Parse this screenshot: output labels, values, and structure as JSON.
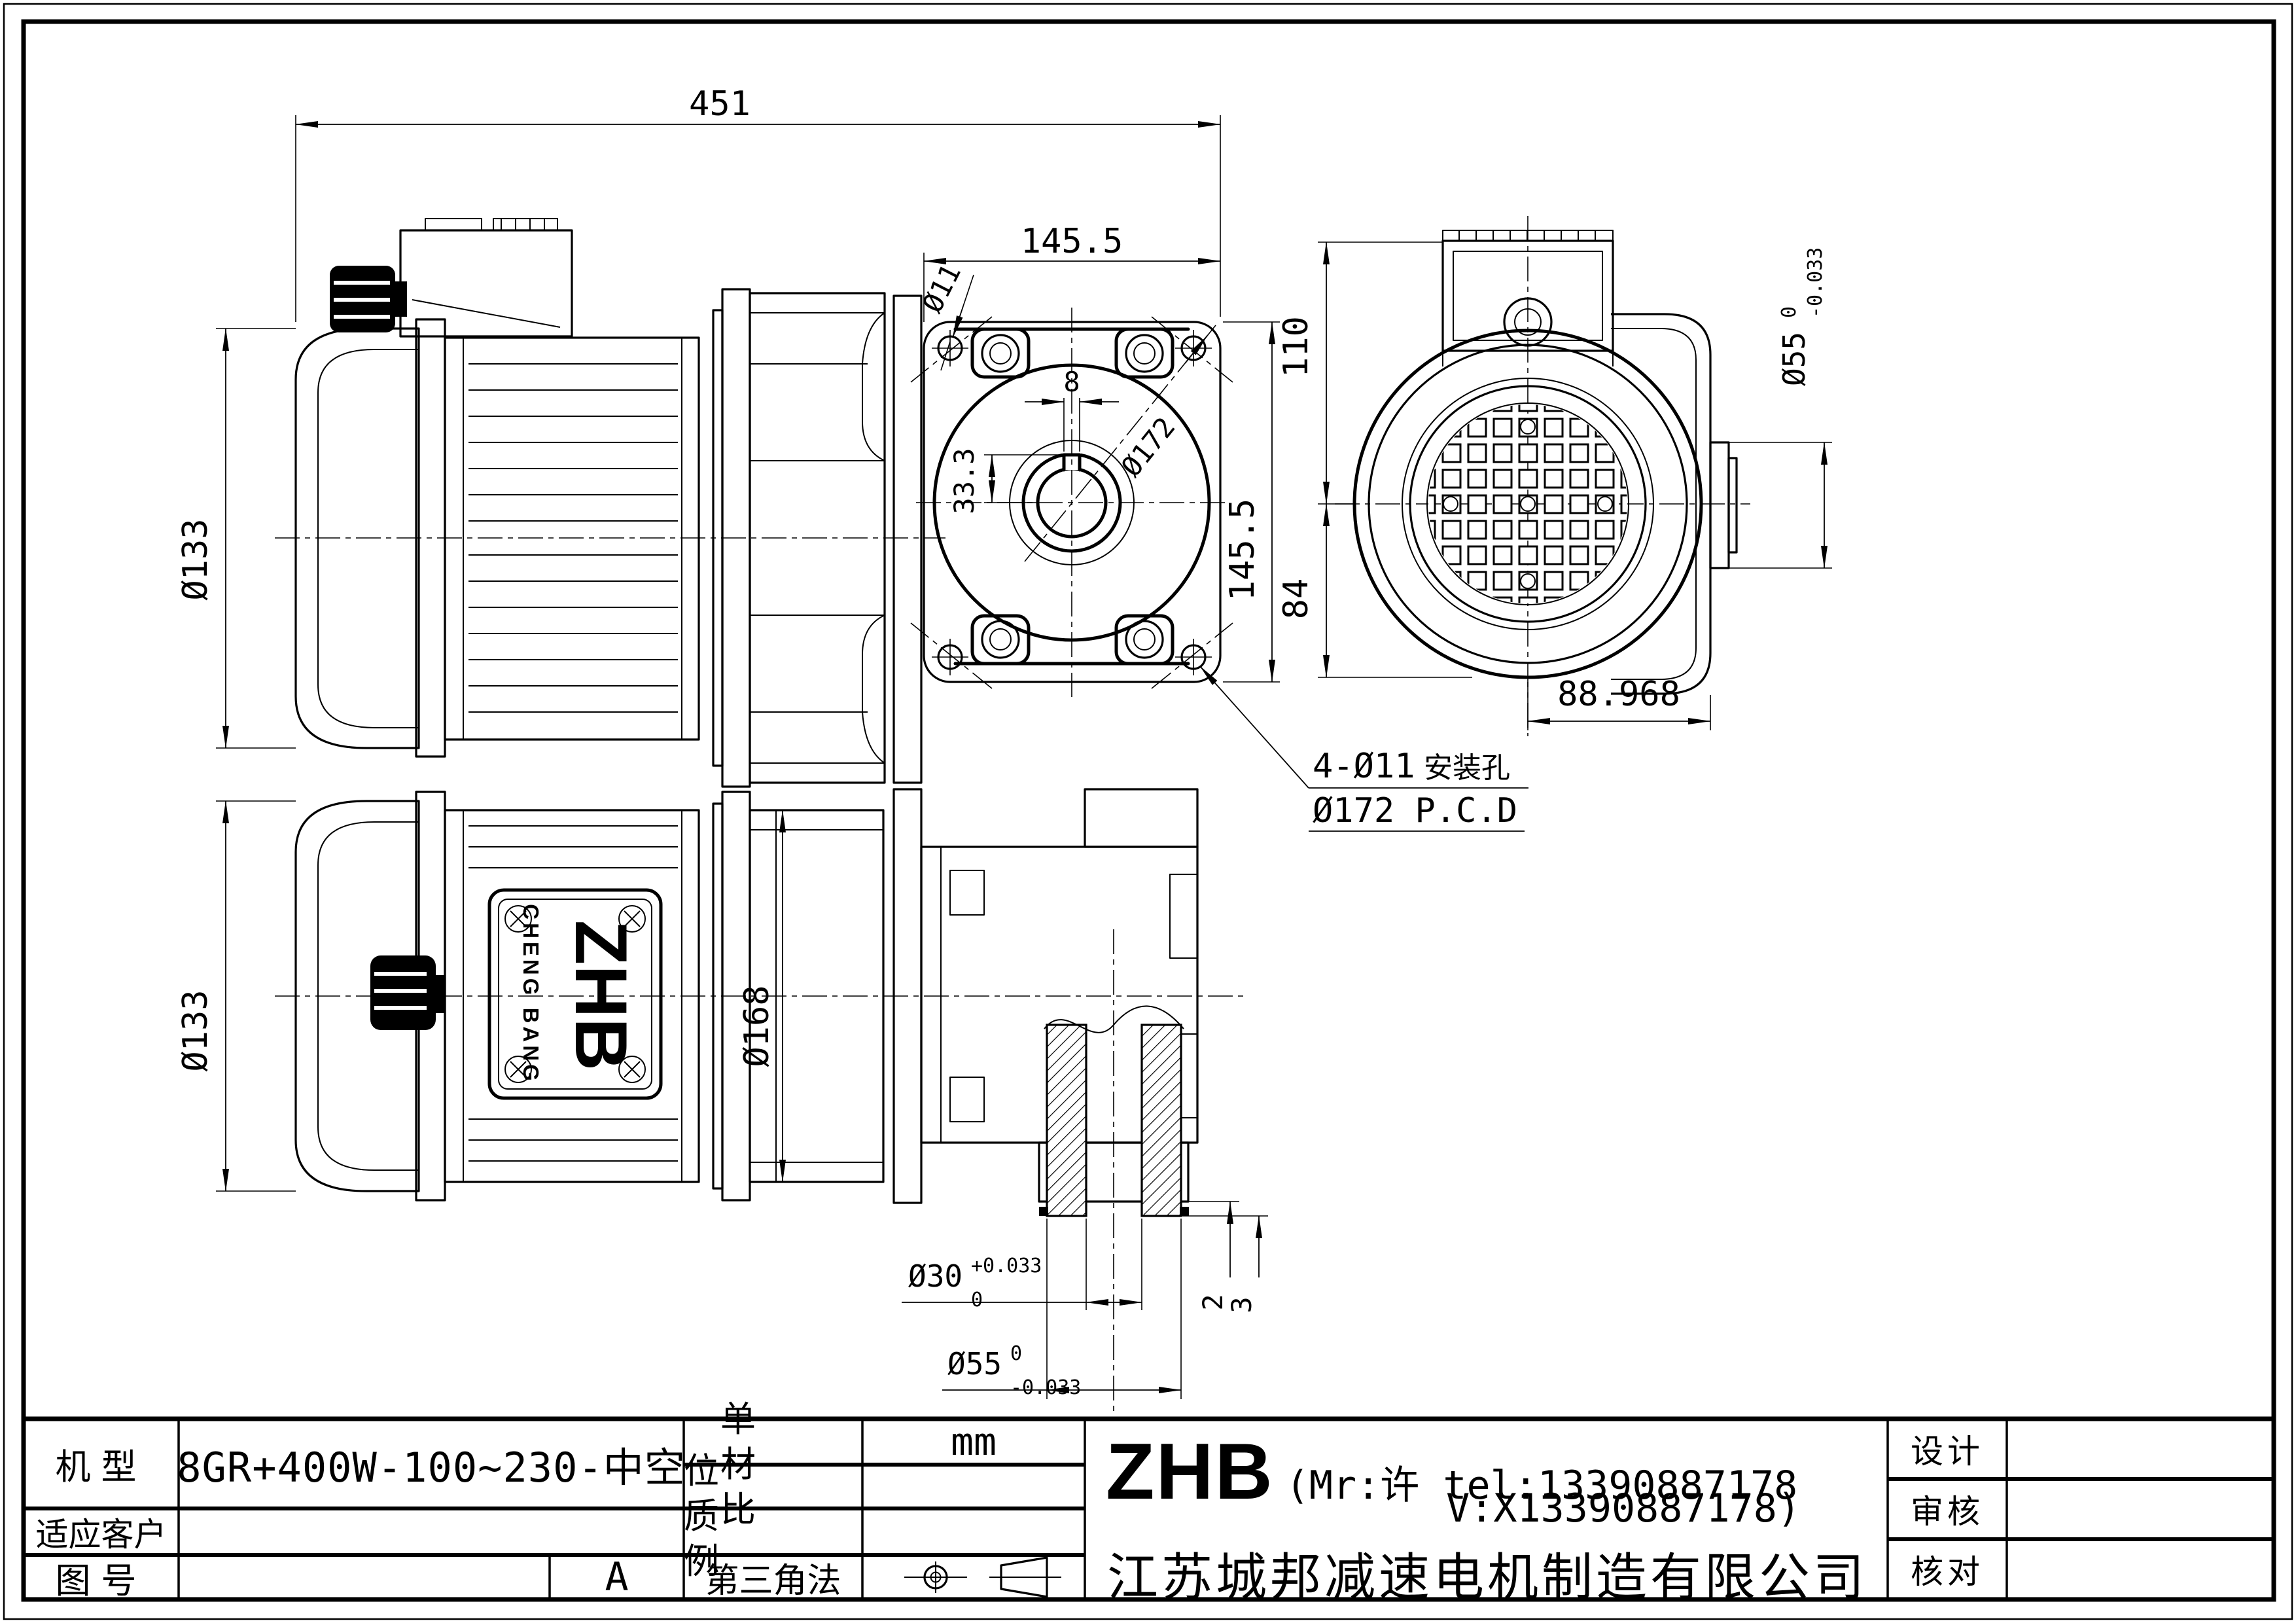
{
  "dims": {
    "d451": "451",
    "d1455_top": "145.5",
    "d1455_right": "145.5",
    "d11": "Ø11",
    "d172": "Ø172",
    "d8": "8",
    "d333": "33.3",
    "d133_top": "Ø133",
    "d133_bottom": "Ø133",
    "d110": "110",
    "d84": "84",
    "d88968": "88.968",
    "d168": "Ø168",
    "d55r_main": "Ø55",
    "d55r_sup": "0",
    "d55r_sub": "-0.033",
    "d30_main": "Ø30",
    "d30_sup": "+0.033",
    "d30_sub": "0",
    "d55b_main": "Ø55",
    "d55b_sup": "0",
    "d55b_sub": "-0.033",
    "d2": "2",
    "d3": "3",
    "note_mounting": "4-Ø11",
    "note_mounting_suffix": "安装孔",
    "note_pcd": "Ø172 P.C.D"
  },
  "nameplate": {
    "brand": "ZHB",
    "maker": "CHENG BANG"
  },
  "title_block": {
    "model_label": "机型",
    "model_value": "8GR+400W-100~230-中空",
    "customer_label": "适应客户",
    "customer_value": "",
    "drawing_no_label": "图号",
    "drawing_no_value": "",
    "revision": "A",
    "unit_label": "单 位",
    "unit_value": "mm",
    "material_label": "材 质",
    "material_value": "",
    "scale_label": "比 例",
    "scale_value": "",
    "projection_label": "第三角法",
    "brand": "ZHB",
    "contact_line1": "(Mr:许 tel:13390887178",
    "contact_line2": "V:X13390887178)",
    "company": "江苏城邦减速电机制造有限公司",
    "designer_label": "设计",
    "designer_value": "",
    "reviewer_label": "审核",
    "reviewer_value": "",
    "checker_label": "核对",
    "checker_value": ""
  }
}
